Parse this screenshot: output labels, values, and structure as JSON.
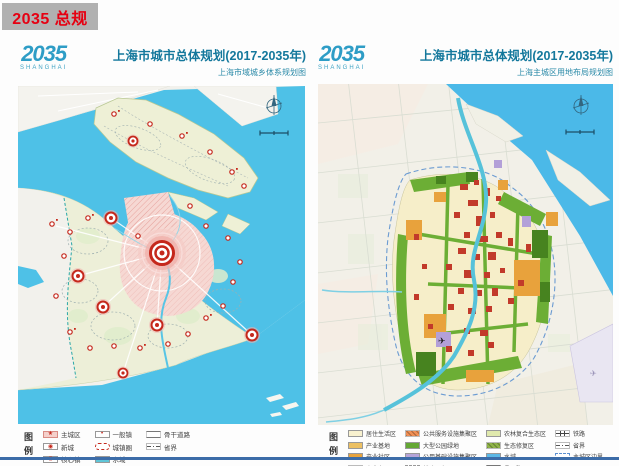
{
  "banner": {
    "label": "2035 总规"
  },
  "panels": [
    {
      "logo_year": "2035",
      "logo_city": "SHANGHAI",
      "title": "上海市城市总体规划(2017-2035年)",
      "subtitle": "上海市域城乡体系规划图",
      "legend_title": "图例",
      "legend_columns": [
        [
          {
            "label": "主城区",
            "swatch": "pink",
            "sym": "★",
            "color": "#f5d0cb"
          },
          {
            "label": "新城",
            "swatch": "fill",
            "sym": "◉"
          },
          {
            "label": "核心镇",
            "swatch": "fill",
            "sym": "◎"
          },
          {
            "label": "中心镇",
            "swatch": "fill",
            "sym": "⊙"
          }
        ],
        [
          {
            "label": "一般镇",
            "swatch": "fill",
            "sym": "•"
          },
          {
            "label": "城镇圈",
            "swatch": "townring"
          },
          {
            "label": "水域",
            "swatch": "fill",
            "color": "#5fc6d8"
          },
          {
            "label": "铁路",
            "swatch": "rail"
          }
        ],
        [
          {
            "label": "骨干道路",
            "swatch": "road"
          },
          {
            "label": "省界",
            "swatch": "dashdot"
          }
        ]
      ]
    },
    {
      "logo_year": "2035",
      "logo_city": "SHANGHAI",
      "title": "上海市城市总体规划(2017-2035年)",
      "subtitle": "上海主城区用地布局规划图",
      "legend_title": "图例",
      "legend_columns": [
        [
          {
            "label": "居住生活区",
            "swatch": "fill",
            "color": "#f8f1cf"
          },
          {
            "label": "产业基地",
            "swatch": "fill",
            "color": "#ecc063"
          },
          {
            "label": "产业社区",
            "swatch": "fill",
            "color": "#e8a33c"
          },
          {
            "label": "商业办公区",
            "swatch": "grid",
            "color": "#cd3a2a"
          }
        ],
        [
          {
            "label": "公共服务设施集聚区",
            "swatch": "hatch",
            "color": "#ef8f55"
          },
          {
            "label": "大型公园绿地",
            "swatch": "fill",
            "color": "#64a734"
          },
          {
            "label": "公用基础设施集聚区",
            "swatch": "fill",
            "color": "#b6a4d8"
          },
          {
            "label": "战略预留区",
            "swatch": "dashedbox"
          }
        ],
        [
          {
            "label": "农林复合生态区",
            "swatch": "fill",
            "color": "#e0e9ad"
          },
          {
            "label": "生态修复区",
            "swatch": "hatch",
            "color": "#8fb348"
          },
          {
            "label": "水域",
            "swatch": "fill",
            "color": "#5cb8e6"
          },
          {
            "label": "骨干路网",
            "swatch": "road"
          }
        ],
        [
          {
            "label": "铁路",
            "swatch": "rail"
          },
          {
            "label": "省界",
            "swatch": "dashdot"
          },
          {
            "label": "主城区边界",
            "swatch": "dashedblue"
          }
        ]
      ]
    }
  ],
  "colors": {
    "banner_bg": "#b1b1b1",
    "accent_red": "#e60012",
    "title_teal": "#14789c",
    "logo_blue": "#2e9dc6",
    "water": "#4ec1e7",
    "main_city_pink": "#f6d8d3",
    "bullseye_red": "#c5281c",
    "green_belt": "#6cae35",
    "footer_line": "#3c6ca8"
  }
}
